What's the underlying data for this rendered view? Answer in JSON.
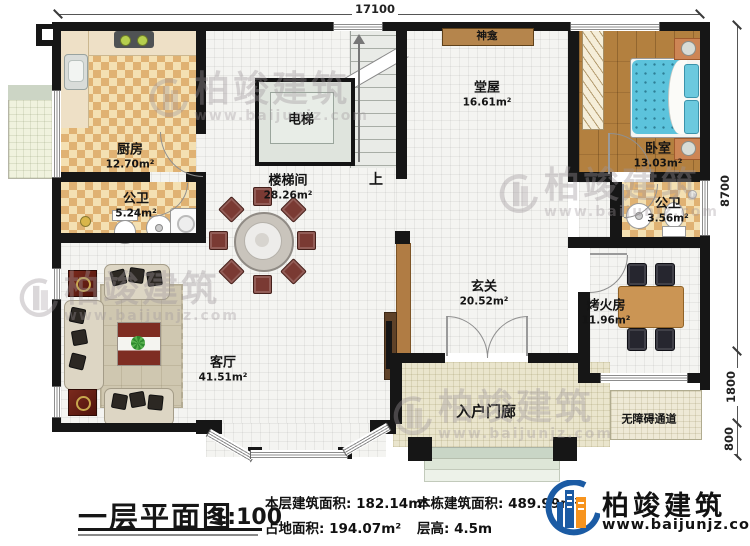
{
  "brand": {
    "name": "柏竣建筑",
    "url": "www.baijunjz.com"
  },
  "plan": {
    "title": "一层平面图",
    "scale": "1:100",
    "stats": [
      {
        "label": "本层建筑面积:",
        "value": "182.14m²"
      },
      {
        "label": "占地面积:",
        "value": "194.07m²"
      },
      {
        "label": "本栋建筑面积:",
        "value": "489.99m²"
      },
      {
        "label": "层高:",
        "value": "4.5m"
      }
    ]
  },
  "dims": {
    "top": "17100",
    "r1": "8700",
    "r2": "1800",
    "r3": "800"
  },
  "rooms": [
    {
      "id": "kitchen",
      "name": "厨房",
      "area": "12.70m²"
    },
    {
      "id": "bath1",
      "name": "公卫",
      "area": "5.24m²"
    },
    {
      "id": "elevator",
      "name": "电梯"
    },
    {
      "id": "stairhall",
      "name": "楼梯间",
      "area": "28.26m²"
    },
    {
      "id": "tangwu",
      "name": "堂屋",
      "area": "16.61m²"
    },
    {
      "id": "shrine",
      "name": "神龛"
    },
    {
      "id": "bedroom",
      "name": "卧室",
      "area": "13.03m²"
    },
    {
      "id": "bath2",
      "name": "公卫",
      "area": "3.56m²"
    },
    {
      "id": "foyer",
      "name": "玄关",
      "area": "20.52m²"
    },
    {
      "id": "fireroom",
      "name": "烤火房",
      "area": "11.96m²"
    },
    {
      "id": "living",
      "name": "客厅",
      "area": "41.51m²"
    },
    {
      "id": "porch",
      "name": "入户门廊"
    },
    {
      "id": "ramp",
      "name": "无障碍通道"
    }
  ],
  "annotations": {
    "up": "上"
  },
  "colors": {
    "wall": "#161616",
    "checker": "#e0b273",
    "wood": "#b3803f",
    "bed": "#5cc3dc",
    "brand_blue": "#1b5ba4",
    "brand_orange": "#f7941e"
  }
}
